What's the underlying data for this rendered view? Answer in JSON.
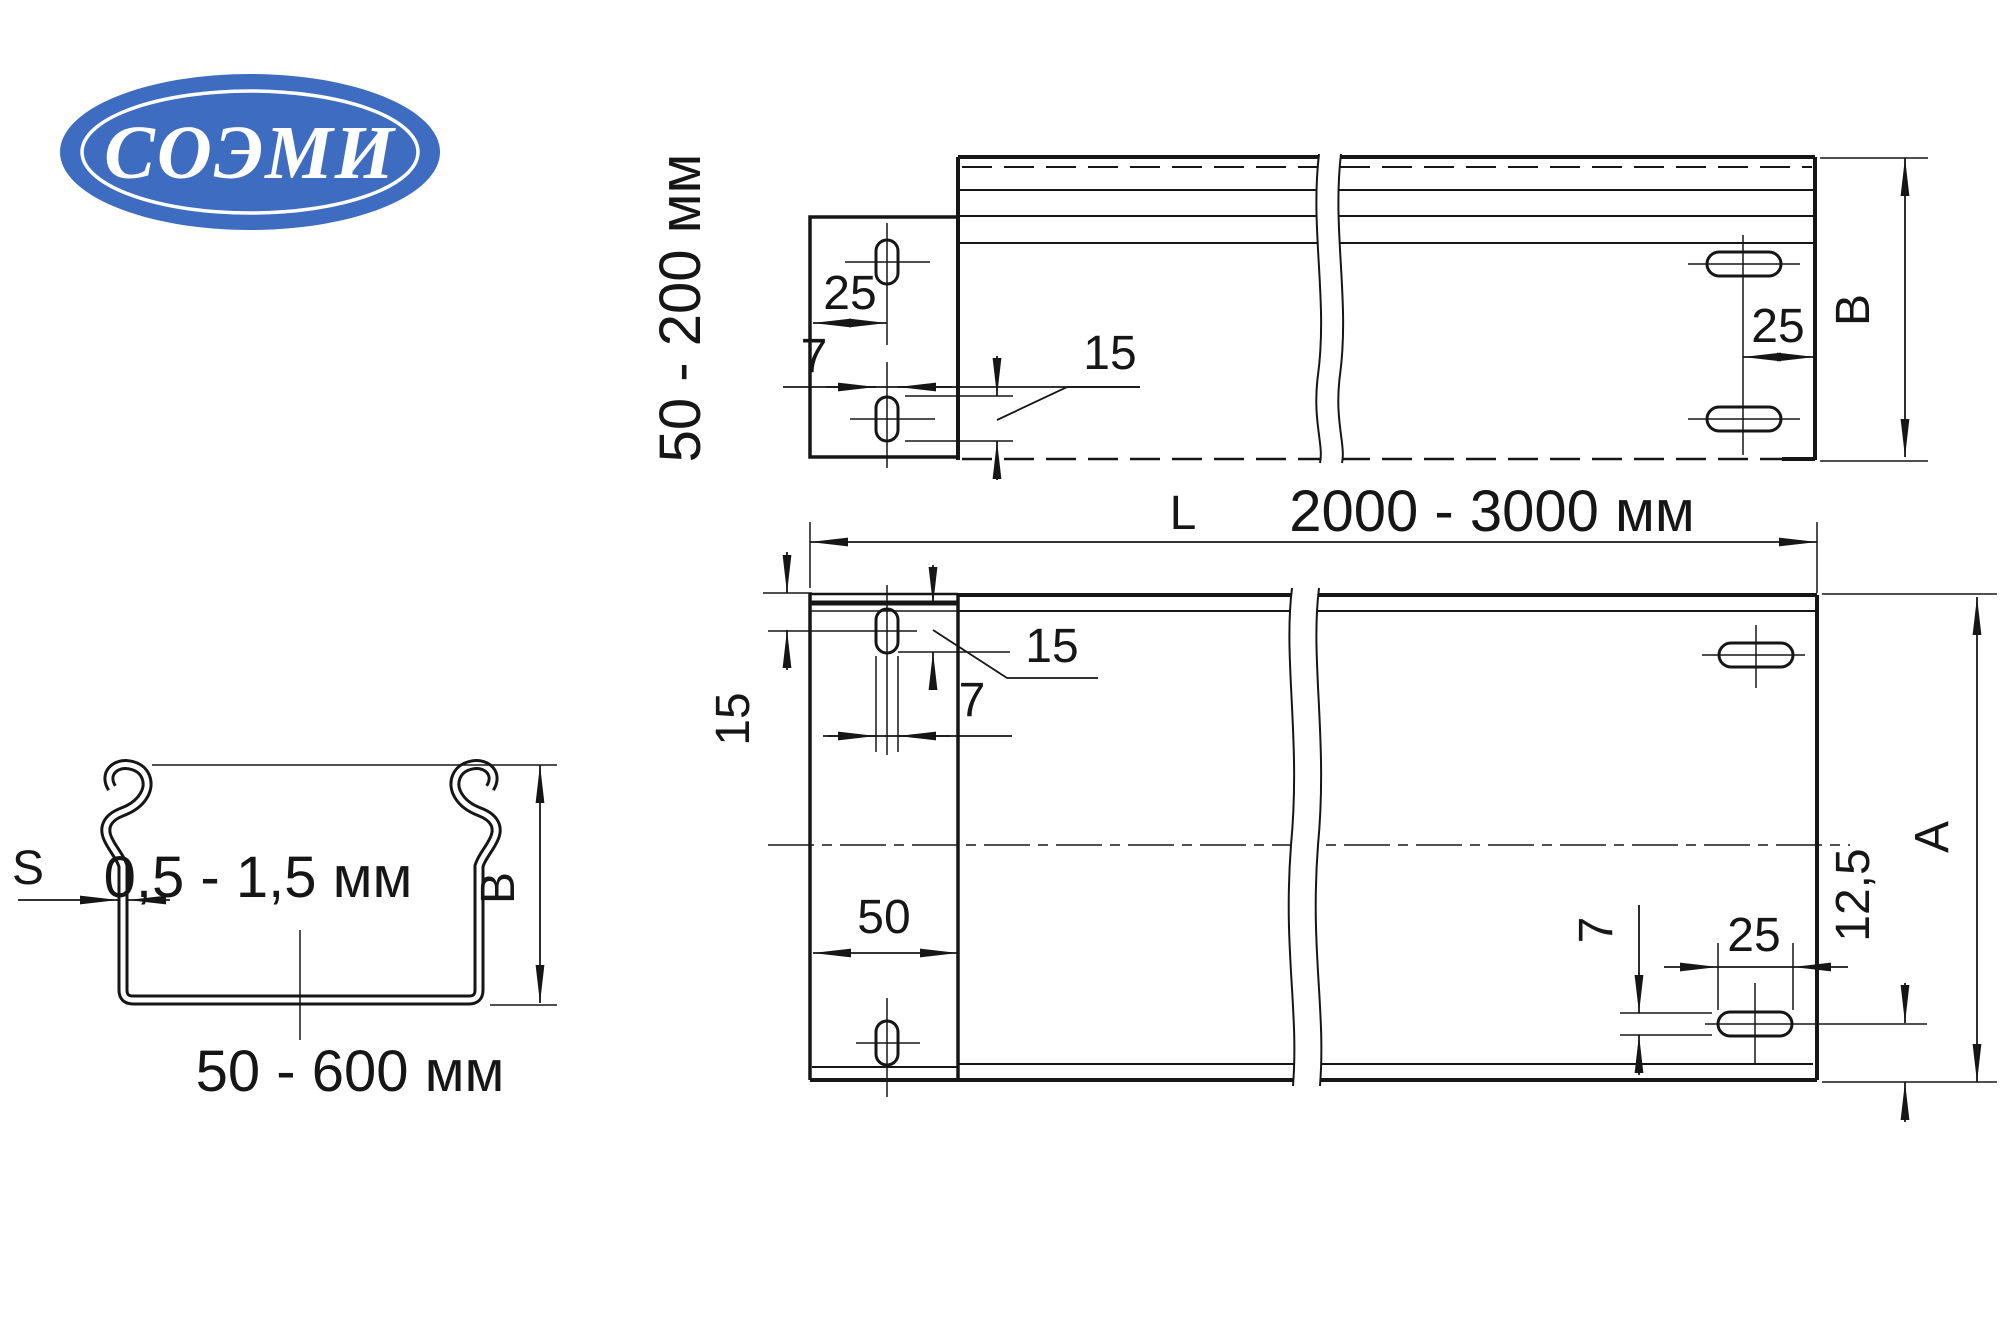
{
  "logo": {
    "text": "СОЭМИ",
    "bg_color": "#3d6cc0",
    "ring_color": "#ffffff"
  },
  "side_view": {
    "rotated_label": "50 - 200 мм",
    "dim_slot_offset": "25",
    "dim_slot_width": "7",
    "dim_slot_length": "15",
    "dim_edge_offset": "25",
    "height_label": "B"
  },
  "plan_view": {
    "length_prefix": "L",
    "length_range": "2000 - 3000 мм",
    "dim_top_to_slot": "15",
    "dim_slot_length": "15",
    "dim_slot_width": "7",
    "dim_bracket_width": "50",
    "dim_right_slot_width": "7",
    "dim_right_slot_length": "25",
    "dim_slot_to_edge": "12,5",
    "width_label": "A"
  },
  "section_view": {
    "thickness_label": "S",
    "thickness_range": "0,5 - 1,5 мм",
    "height_label": "B",
    "width_range": "50 - 600 мм"
  }
}
